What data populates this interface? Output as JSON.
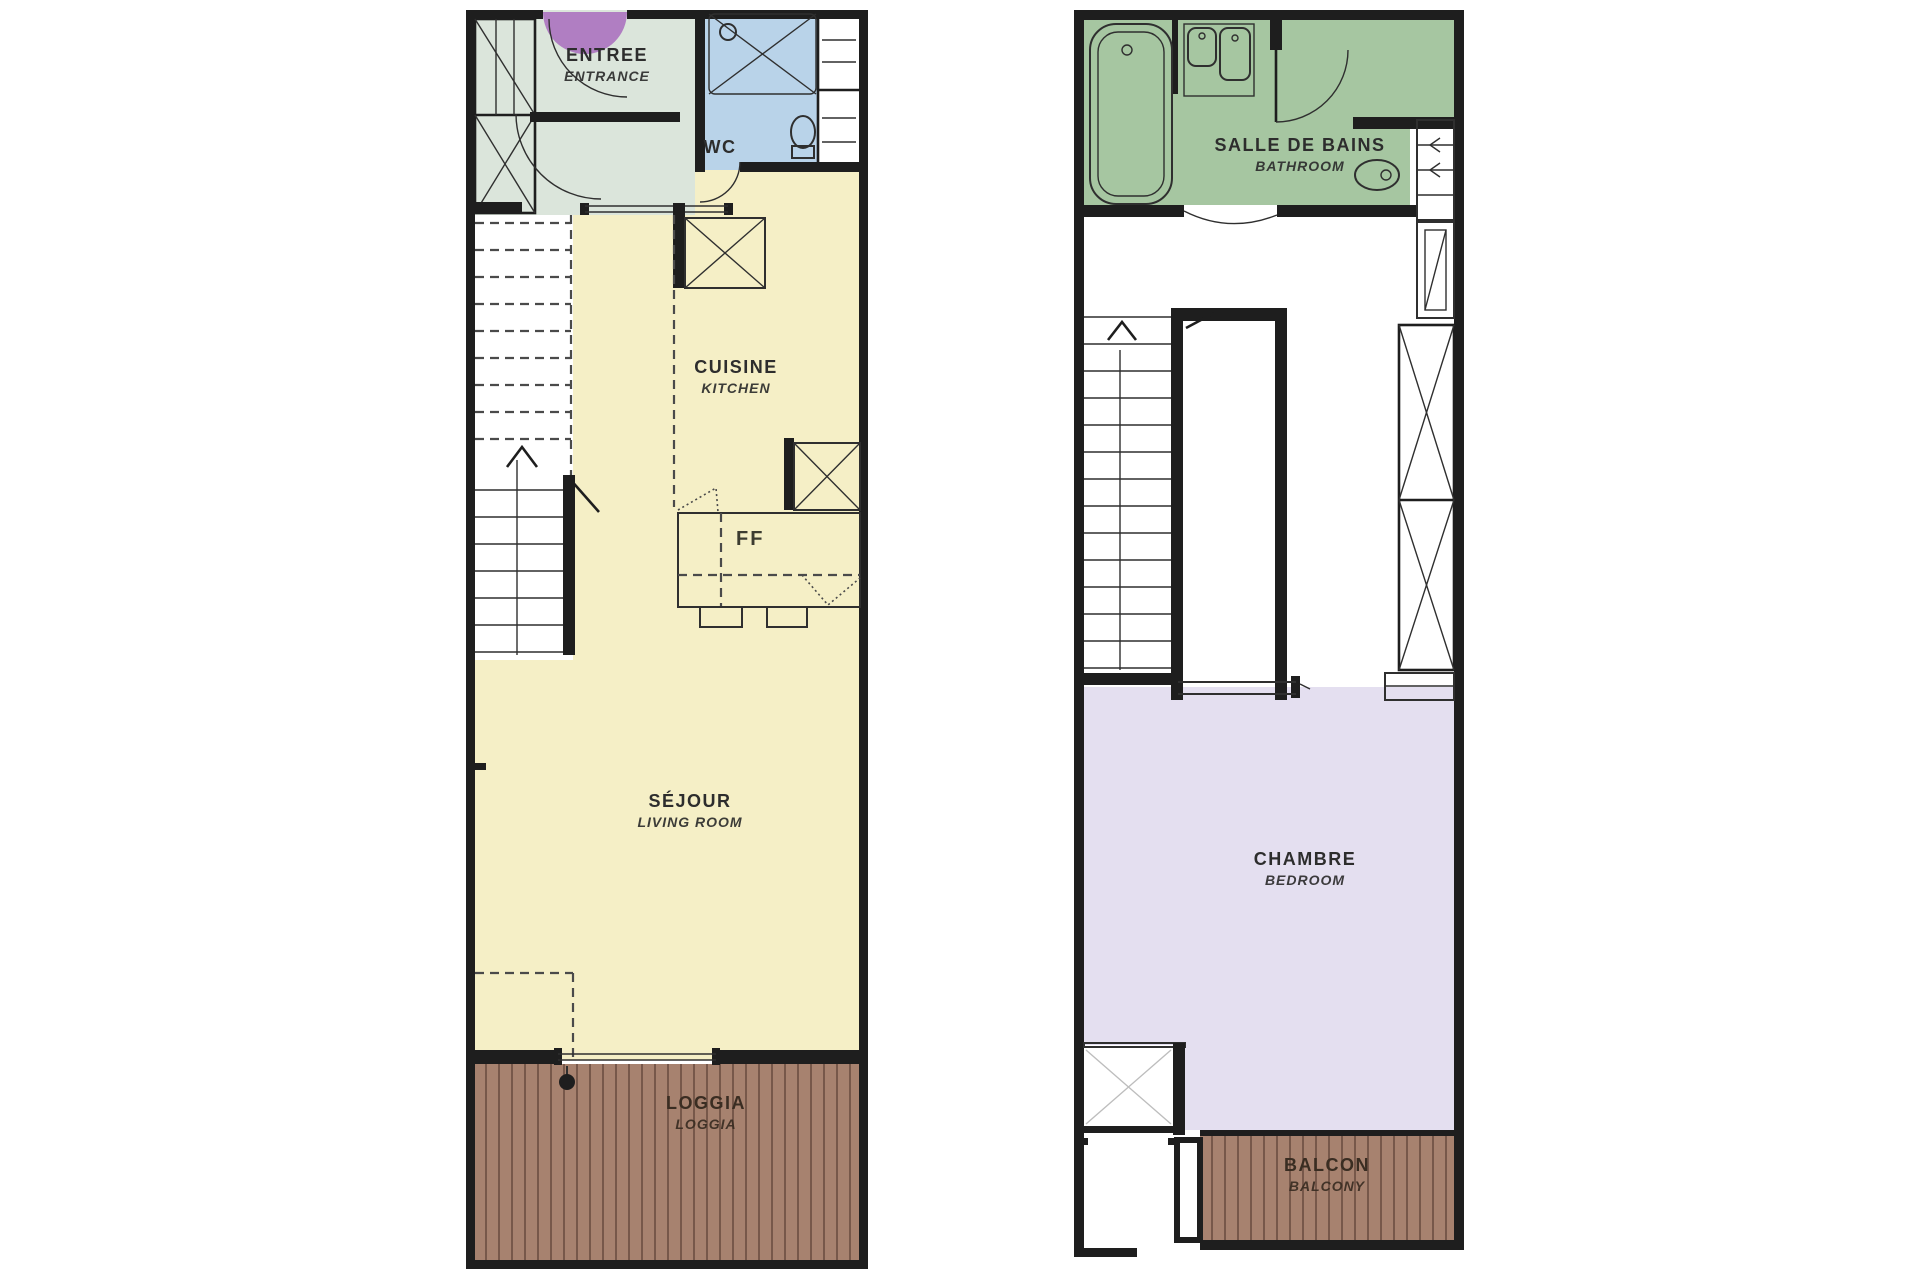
{
  "document_title": "Duplex apartment floor plan",
  "colors": {
    "wall": "#1e1e1e",
    "entrance_mint": "#dbe5db",
    "wc_blue": "#b9d3e9",
    "kitchen_living_yellow": "#f5efc6",
    "deck_brown": "#a7826f",
    "bathroom_green": "#a6c6a1",
    "bedroom_lavender": "#e4dff0",
    "entry_door_purple": "#b07ec2",
    "label_text": "#2d2d2d"
  },
  "plans": {
    "level1": {
      "rooms": {
        "entrance": {
          "label": "ENTREE",
          "sublabel": "ENTRANCE"
        },
        "wc": {
          "label": "WC"
        },
        "kitchen": {
          "label": "CUISINE",
          "sublabel": "KITCHEN"
        },
        "living": {
          "label": "SÉJOUR",
          "sublabel": "LIVING ROOM"
        },
        "loggia": {
          "label": "LOGGIA",
          "sublabel": "LOGGIA"
        }
      },
      "fixtures": {
        "cooktop_mark": "FF"
      }
    },
    "level2": {
      "rooms": {
        "bathroom": {
          "label": "SALLE DE BAINS",
          "sublabel": "BATHROOM"
        },
        "bedroom": {
          "label": "CHAMBRE",
          "sublabel": "BEDROOM"
        },
        "balcony": {
          "label": "BALCON",
          "sublabel": "BALCONY"
        }
      }
    }
  }
}
